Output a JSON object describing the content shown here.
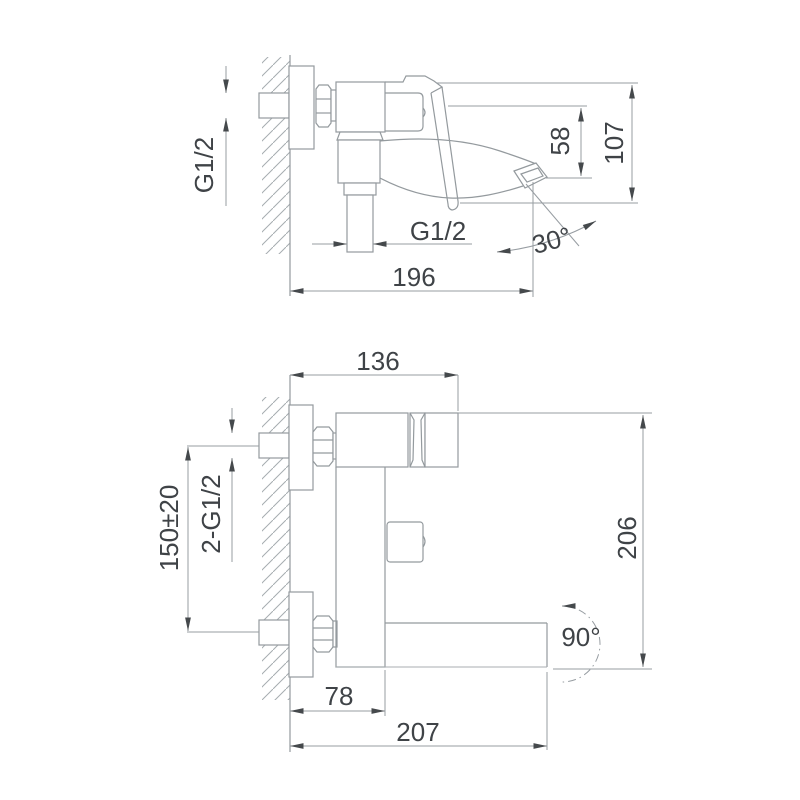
{
  "drawing_type": "faucet installation dimension drawing",
  "colors": {
    "background": "#ffffff",
    "line": "#949a9e",
    "dimension_line": "#979da2",
    "text": "#3f4347",
    "arrow": "#45494c",
    "hatch": "#a6acb0"
  },
  "side_view": {
    "labels": {
      "inlet_thread": "G1/2",
      "spout_drop_height": "58",
      "overall_height": "107",
      "shower_outlet_thread": "G1/2",
      "spout_angle": "30°",
      "overall_depth": "196"
    }
  },
  "front_view": {
    "labels": {
      "body_depth": "136",
      "inlet_spacing": "150±20",
      "inlet_threads": "2-G1/2",
      "overall_height": "206",
      "swivel_angle": "90°",
      "wall_to_spout": "78",
      "overall_length": "207"
    }
  }
}
